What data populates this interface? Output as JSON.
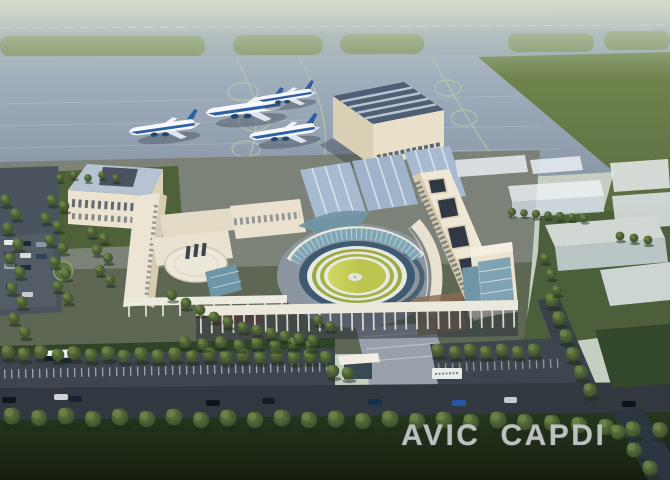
{
  "scene": {
    "description": "Aerial architectural rendering of a campus beside an airport apron with four parked airliners, a large hangar, office buildings around a circular lawn courtyard, translucent future-phase buildings, tree-lined roads and a dark lawn foreground"
  },
  "watermark": {
    "word1": "AVIC",
    "word2": "CAPDI"
  },
  "colors": {
    "haze": "#c9d3c5",
    "runway": "#a8b4c1",
    "taxiway": "#9dabb9",
    "grass_island": "#82945f",
    "field": "#6e8250",
    "apron": "#9dabbb",
    "taxi_guide_line": "#bccaa6",
    "plane_body": "#f6f8fb",
    "plane_stripe": "#2e5fa3",
    "hangar_wall": "#e9e0ca",
    "hangar_roof": "#4e5f75",
    "hall_roof": "#a6bad0",
    "building_cream": "#ebe3cf",
    "roof_light_blue": "#b6c3d3",
    "glass_teal": "#6f96a6",
    "courtyard_lawn": "#bcc54f",
    "ring_white": "#e7e8e0",
    "water_ring": "#3d5a70",
    "future_building": "#eef2f6",
    "tree": "#4c6134",
    "road": "#32383f",
    "foreground_lawn": "#273820",
    "watermark": "#c7ccce"
  }
}
